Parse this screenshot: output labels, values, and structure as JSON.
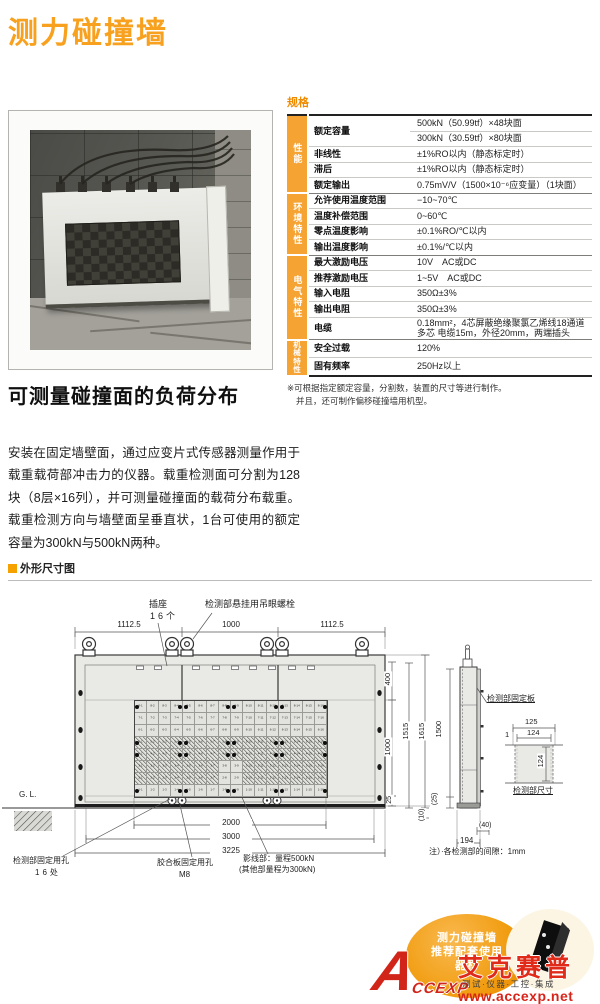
{
  "page": {
    "title": "测力碰撞墙",
    "accent_color": "#F5A200",
    "brand_red": "#D8251C"
  },
  "spec": {
    "heading": "规格",
    "groups": [
      {
        "name": "性能",
        "rows": [
          {
            "label": "额定容量",
            "span": 2,
            "value": "500kN（50.99tf）×48块面"
          },
          {
            "merge": true,
            "value": "300kN（30.59tf）×80块面"
          },
          {
            "label": "非线性",
            "value": "±1%RO以内（静态标定时）"
          },
          {
            "label": "滞后",
            "value": "±1%RO以内（静态标定时）"
          },
          {
            "label": "额定输出",
            "value": "0.75mV/V（1500×10⁻⁶应变量）（1块面）"
          }
        ]
      },
      {
        "name": "环境特性",
        "rows": [
          {
            "label": "允许使用温度范围",
            "value": "−10~70℃"
          },
          {
            "label": "温度补偿范围",
            "value": "0~60℃"
          },
          {
            "label": "零点温度影响",
            "value": "±0.1%RO/℃以内"
          },
          {
            "label": "输出温度影响",
            "value": "±0.1%/℃以内"
          }
        ]
      },
      {
        "name": "电气特性",
        "rows": [
          {
            "label": "最大激励电压",
            "value": "10V　AC或DC"
          },
          {
            "label": "推荐激励电压",
            "value": "1~5V　AC或DC"
          },
          {
            "label": "输入电阻",
            "value": "350Ω±3%"
          },
          {
            "label": "输出电阻",
            "value": "350Ω±3%"
          },
          {
            "label": "电缆",
            "value": "0.18mm²，4芯屏蔽绝缘聚氯乙烯线18通道多芯 电缆15m，外径20mm，两端插头"
          }
        ]
      },
      {
        "name": "机械特性",
        "rows": [
          {
            "label": "安全过载",
            "value": "120%"
          },
          {
            "label": "固有频率",
            "value": "250Hz以上"
          }
        ]
      }
    ],
    "footnote1": "※可根据指定额定容量，分割数，装置的尺寸等进行制作。",
    "footnote2": "并且，还可制作偏移碰撞墙用机型。"
  },
  "intro": {
    "heading": "可测量碰撞面的负荷分布",
    "body": "安装在固定墙壁面，通过应变片式传感器测量作用于载重载荷部冲击力的仪器。载重检测面可分割为128块（8层×16列），并可测量碰撞面的载荷分布载重。载重检测方向与墙壁面呈垂直状，1台可使用的额定容量为300kN与500kN两种。"
  },
  "drawing": {
    "heading": "外形尺寸图",
    "labels": {
      "socket": "插座",
      "socket_count": "16个",
      "eyebolt": "检测部悬挂用吊眼螺栓",
      "gl": "G. L.",
      "hole1": "检测部固定用孔",
      "hole1_count": "16处",
      "hole2": "胶合板固定用孔",
      "hole2_size": "M8",
      "hatch1": "影线部：量程500kN",
      "hatch2": "(其他部量程为300kN)",
      "gap_note": "注）·各检测部的间隙：1mm",
      "plate": "检测部固定板",
      "detail_title": "检测部尺寸"
    },
    "dims": {
      "top1": "1112.5",
      "top2": "1000",
      "top3": "1112.5",
      "d400": "400",
      "d1000": "1000",
      "d1515": "1515",
      "d1615": "1615",
      "d25": "25",
      "d10": "(10)",
      "b2000": "2000",
      "b3000": "3000",
      "b3225": "3225",
      "s1500": "1500",
      "s25": "(25)",
      "s194": "194",
      "s40": "(40)",
      "dd125": "125",
      "dd124": "124",
      "dd1": "1",
      "dd124v": "124"
    },
    "grid": {
      "rows": 8,
      "cols": 16,
      "hatch_full_rows": [
        5,
        4
      ],
      "hatch_partial_rows": [
        3,
        2
      ],
      "partial_clear_cols": [
        8,
        9
      ],
      "dot_rows": [
        0,
        3,
        4,
        7
      ],
      "dot_cols_frac": [
        0.008,
        0.234,
        0.266,
        0.484,
        0.516,
        0.734,
        0.766,
        0.992
      ]
    }
  },
  "footer": {
    "badge1": "测力碰撞墙",
    "badge2": "推荐配套使用",
    "badge3": "器材",
    "logo_letter": "A",
    "logo_rest": "CCEXP",
    "brand": "艾克赛普",
    "tagline": "测试·仪器·工控·集成",
    "url": "www.accexp.net"
  }
}
